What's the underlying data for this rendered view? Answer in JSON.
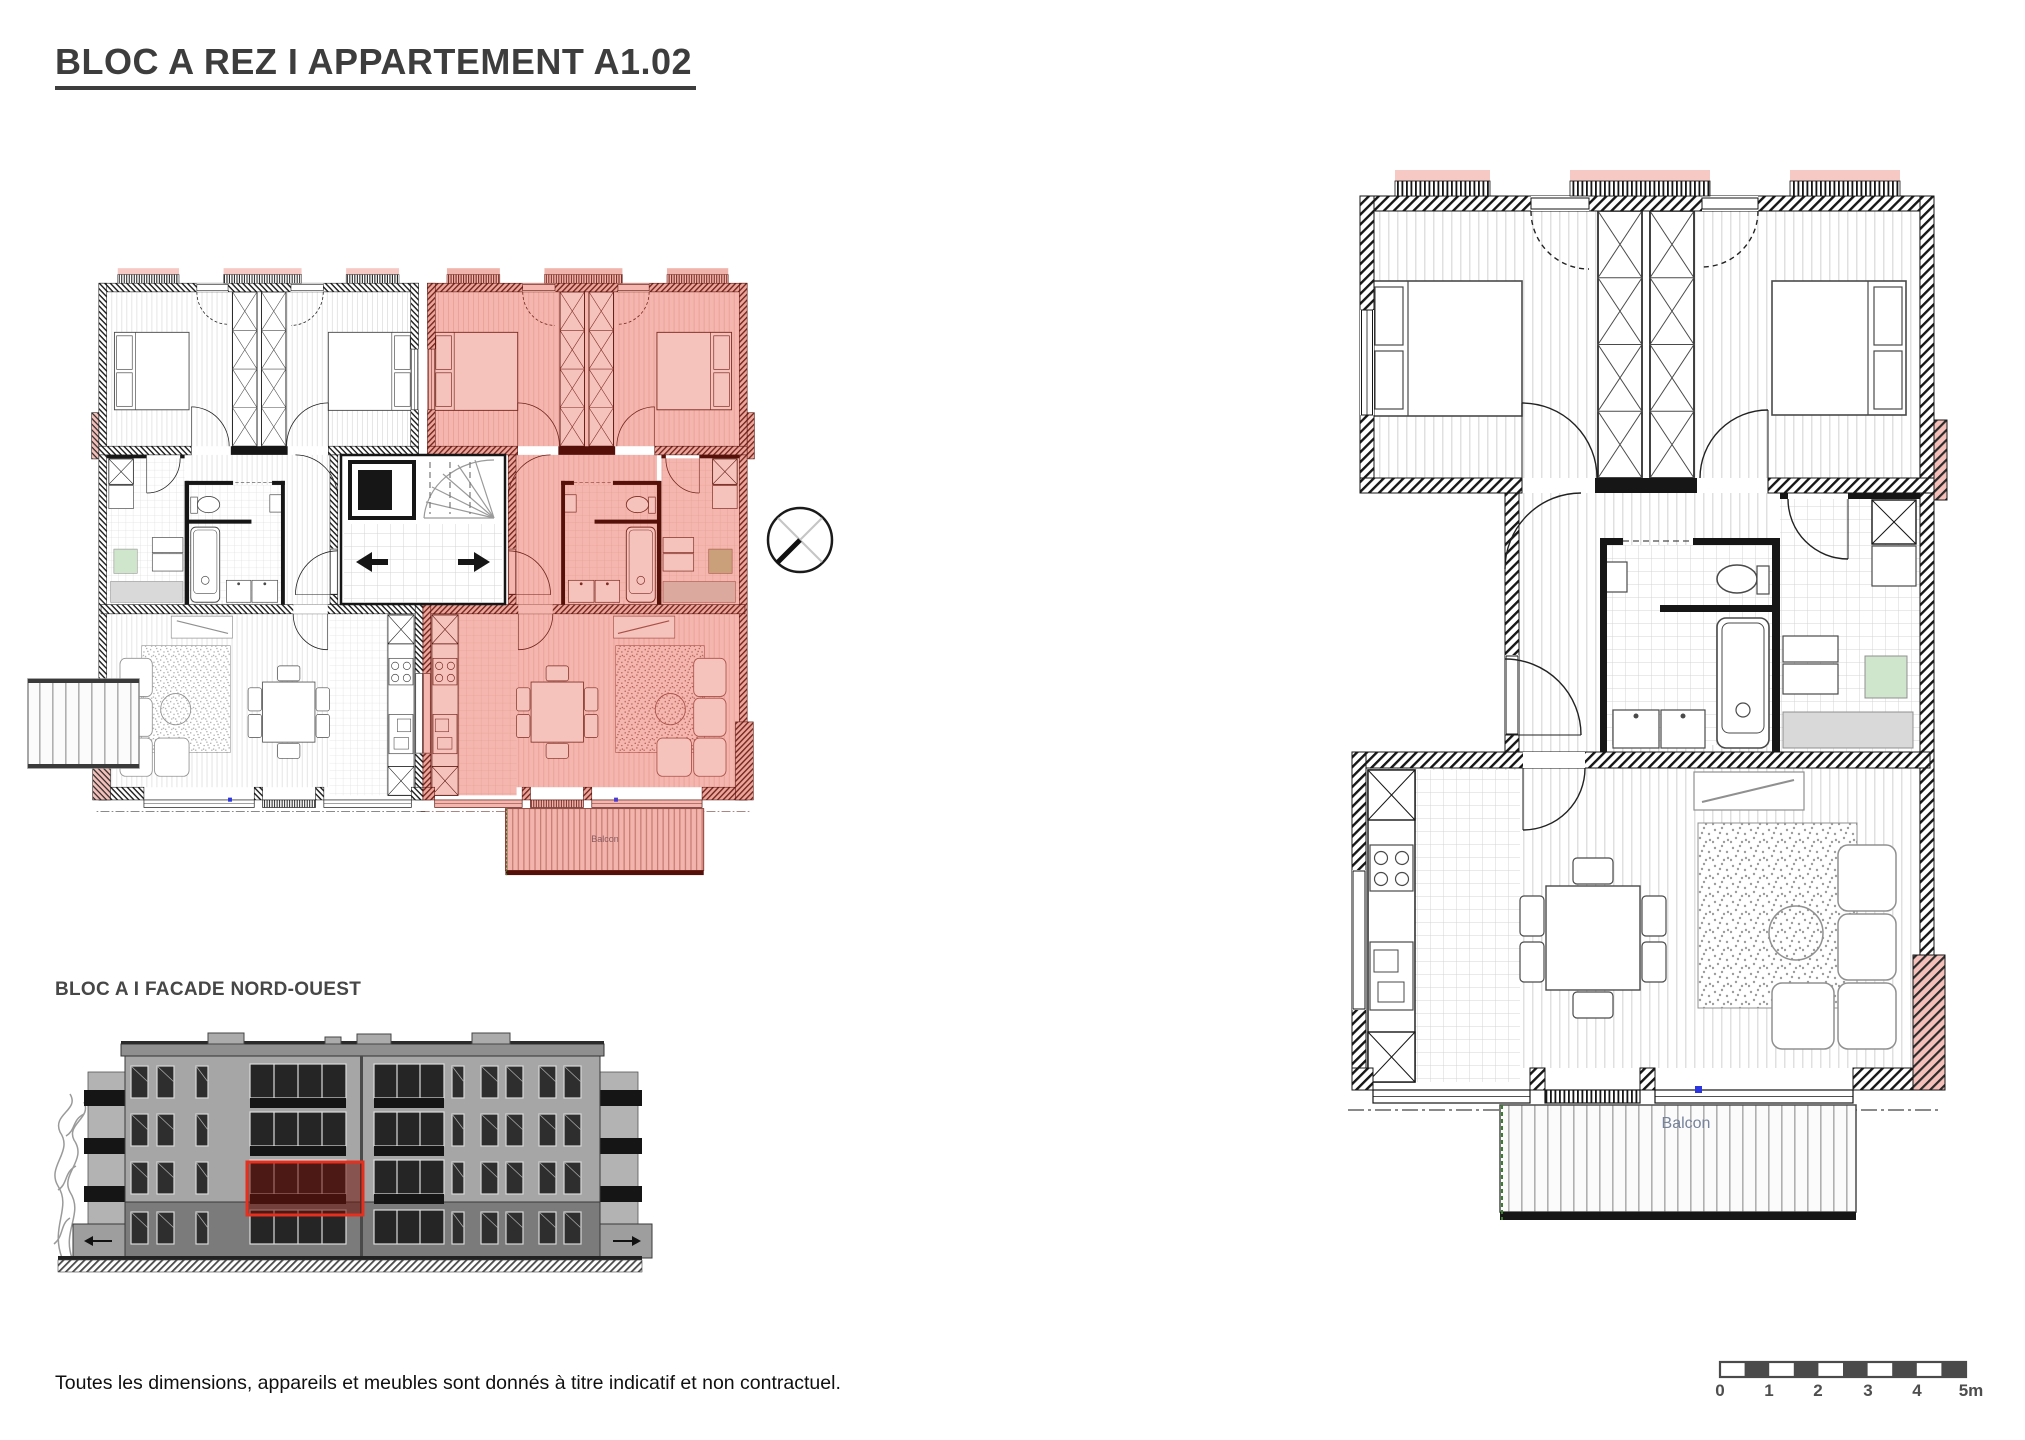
{
  "title": "BLOC A REZ I APPARTEMENT A1.02",
  "footnote": "Toutes les dimensions, appareils et meubles sont donnés à titre indicatif et non contractuel.",
  "facade": {
    "label": "BLOC A I FACADE NORD-OUEST"
  },
  "detail_plan": {
    "balcony_label": "Balcon"
  },
  "overview_plan": {
    "balcony_label": "Balcon"
  },
  "scale_bar": {
    "labels": [
      "0",
      "1",
      "2",
      "3",
      "4",
      "5m"
    ]
  },
  "colors": {
    "highlight_fill": "#f4b6ae",
    "highlight_wall": "#551109",
    "accent_green": "#cfe5cc",
    "accent_tan": "#c9a07a",
    "facade_highlight": "#e5301f",
    "blue_marker": "#2b35e0",
    "balcony_text": "#76839b",
    "scale_dark": "#4a4a4a"
  }
}
